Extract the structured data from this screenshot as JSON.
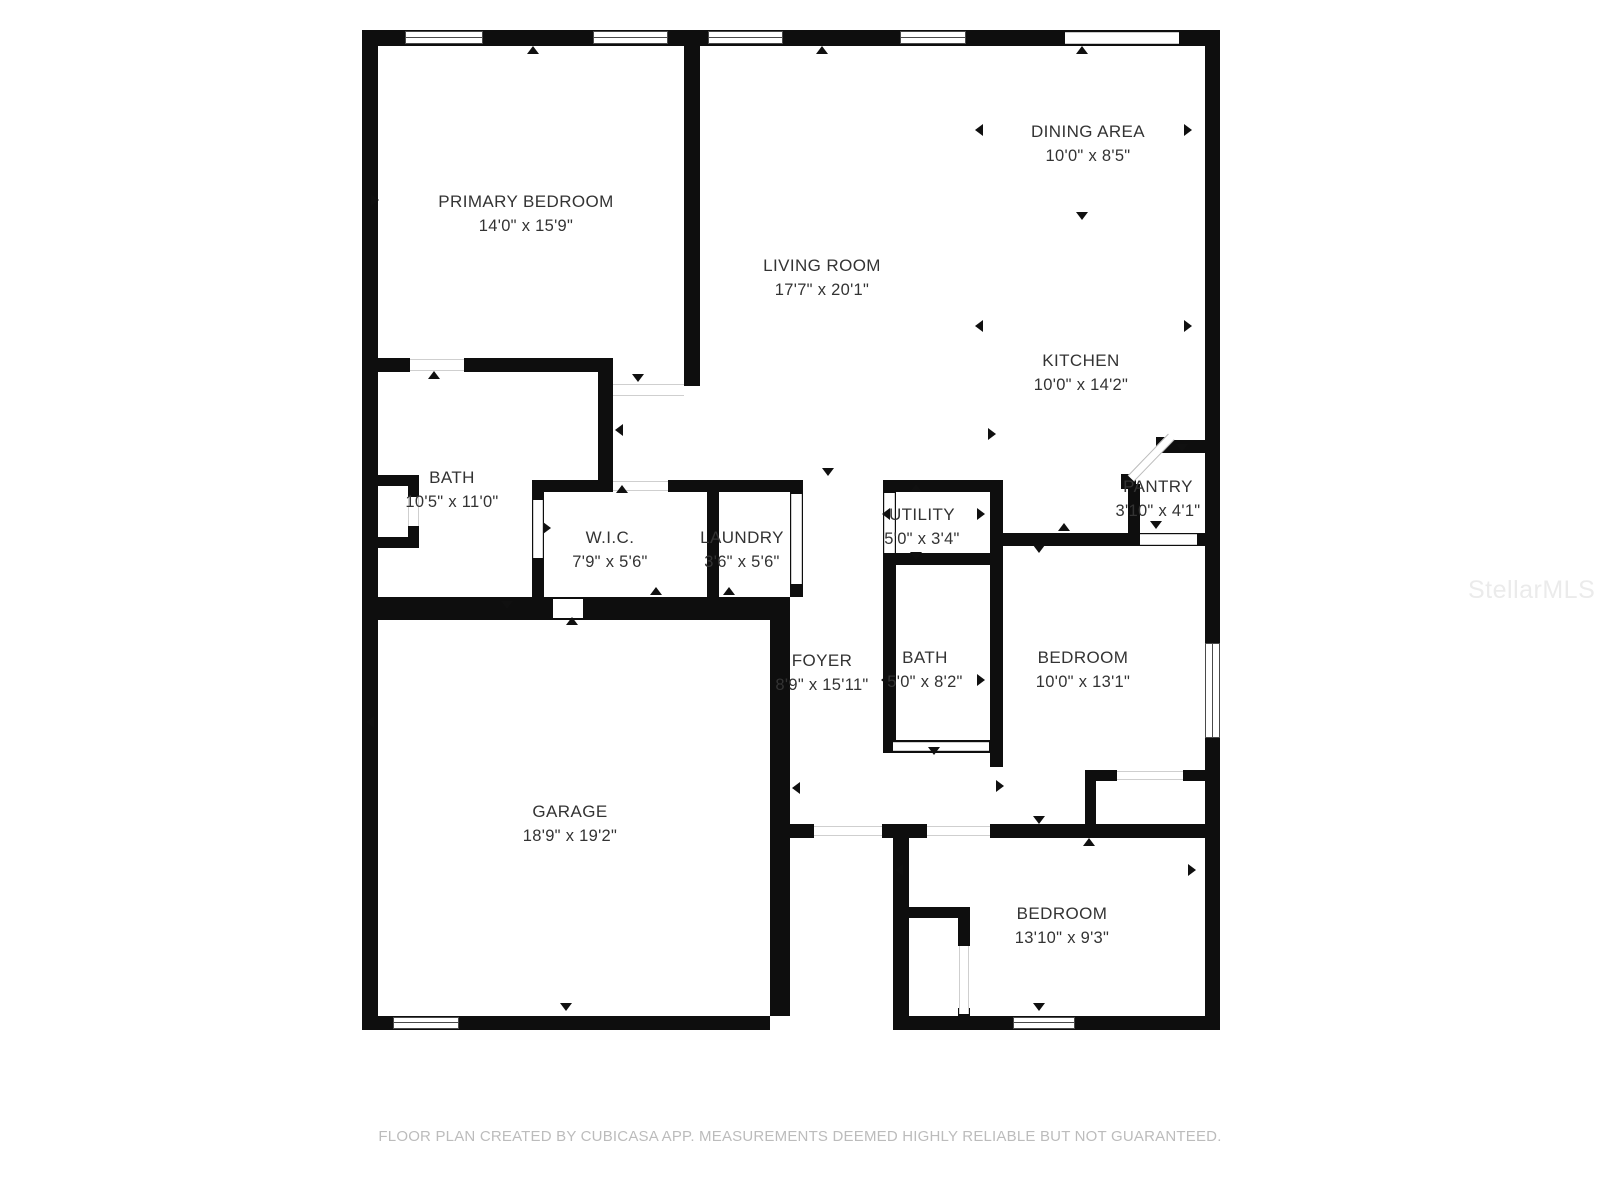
{
  "rooms": {
    "primary_bedroom": {
      "name": "PRIMARY BEDROOM",
      "dims": "14'0\" x 15'9\""
    },
    "living_room": {
      "name": "LIVING ROOM",
      "dims": "17'7\" x 20'1\""
    },
    "dining_area": {
      "name": "DINING AREA",
      "dims": "10'0\" x 8'5\""
    },
    "kitchen": {
      "name": "KITCHEN",
      "dims": "10'0\" x 14'2\""
    },
    "bath_primary": {
      "name": "BATH",
      "dims": "10'5\" x 11'0\""
    },
    "wic": {
      "name": "W.I.C.",
      "dims": "7'9\" x 5'6\""
    },
    "laundry": {
      "name": "LAUNDRY",
      "dims": "3'6\" x 5'6\""
    },
    "utility": {
      "name": "UTILITY",
      "dims": "5'0\" x 3'4\""
    },
    "pantry": {
      "name": "PANTRY",
      "dims": "3'10\" x 4'1\""
    },
    "foyer": {
      "name": "FOYER",
      "dims": "8'9\" x 15'11\""
    },
    "bath_hall": {
      "name": "BATH",
      "dims": "5'0\" x 8'2\""
    },
    "bedroom_right": {
      "name": "BEDROOM",
      "dims": "10'0\" x 13'1\""
    },
    "garage": {
      "name": "GARAGE",
      "dims": "18'9\" x 19'2\""
    },
    "bedroom_bottom": {
      "name": "BEDROOM",
      "dims": "13'10\" x 9'3\""
    }
  },
  "footer": {
    "disclaimer": "FLOOR PLAN CREATED BY CUBICASA APP. MEASUREMENTS DEEMED HIGHLY RELIABLE BUT NOT GUARANTEED."
  },
  "watermark": {
    "text": "StellarMLS"
  },
  "colors": {
    "wall": "#0e0e0e",
    "label": "#333333",
    "footer": "#bcbcbc"
  }
}
